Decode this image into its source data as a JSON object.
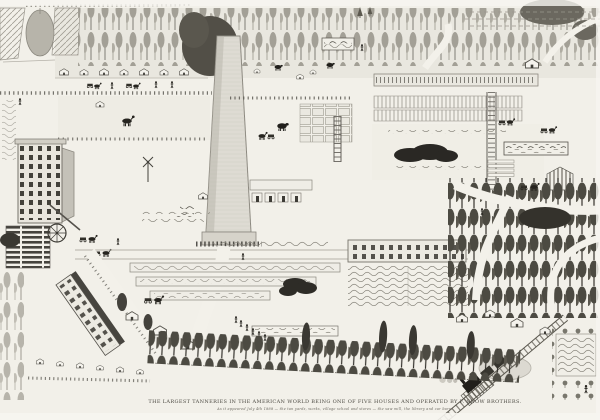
{
  "artwork": {
    "kind": "hand-drawn folk-art bird's-eye map of a tannery village with central monument chimney",
    "caption": {
      "title": "THE LARGEST TANNERIES IN THE AMERICAN WORLD BEING ONE OF FIVE HOUSES AND OPERATED BY F. SNOW BROTHERS.",
      "subtitle": "As it appeared July 4th 1888 — the tan yards, works, village school and stores — the saw mill, the library and car barn."
    },
    "palette": {
      "paper": "#f2f0e9",
      "ink": "#3c3a34",
      "forest_dark": "#4c4a42",
      "forest_light": "#a3a096",
      "shade": "#8b887f"
    }
  }
}
